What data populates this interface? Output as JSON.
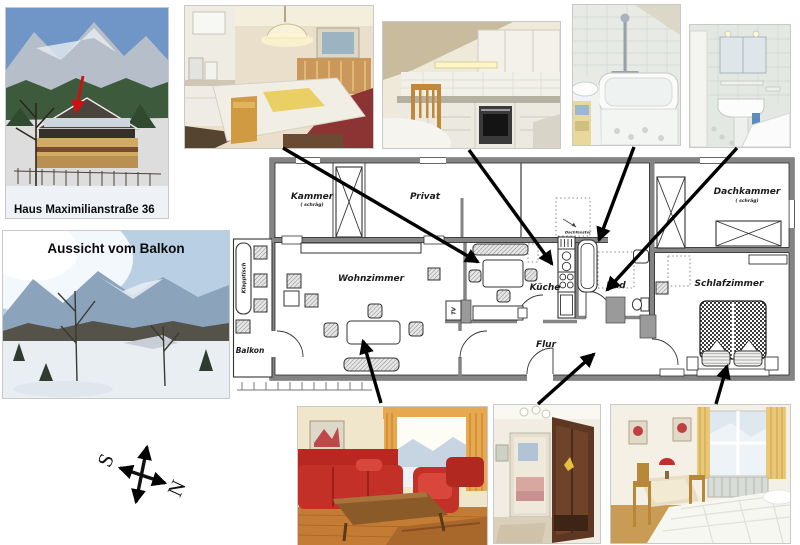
{
  "photos": {
    "house": {
      "caption": "Haus Maximilianstraße 36"
    },
    "balcony": {
      "caption": "Aussicht vom Balkon"
    }
  },
  "compass": {
    "south": "S",
    "north": "N"
  },
  "floorplan": {
    "kammer": "Kammer",
    "kammer_sub": "( schräg)",
    "privat": "Privat",
    "dachkammer": "Dachkammer",
    "dachkammer_sub": "( schräg)",
    "wohnzimmer": "Wohnzimmer",
    "kueche": "Küche",
    "bad": "Bad",
    "schlafzimmer": "Schlafzimmer",
    "flur": "Flur",
    "balkon": "Balkon",
    "klapptisch": "Klapptisch",
    "tv": "TV",
    "dachfenster": "Dachfenster"
  },
  "colors": {
    "wall_gray": "#848484",
    "arrow_black": "#000000",
    "pointer_red": "#cc1111",
    "paper": "#ffffff"
  }
}
